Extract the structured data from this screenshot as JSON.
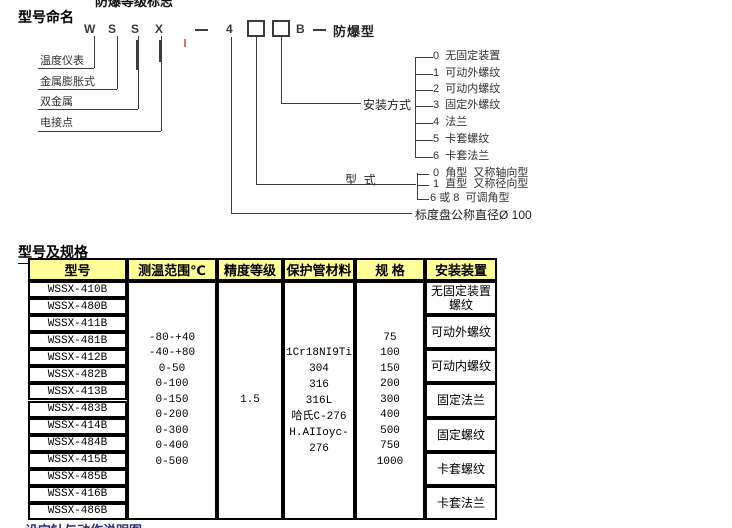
{
  "page": {
    "top_clipped_text": "防爆等级标志",
    "bottom_clipped_text": "设定针与动作说明图"
  },
  "colors": {
    "table_header_bg": "#FFFF99",
    "table_border": "#000000",
    "diagram_line": "#3d3d3d",
    "clipped_heading_text": "#2b2b7a"
  },
  "section1": {
    "title": "型号命名",
    "code": {
      "letters": [
        "W",
        "S",
        "S",
        "X"
      ],
      "dash1": "—",
      "digit": "4",
      "suffix_letter": "B",
      "dash2": "—",
      "suffix_label": "防爆型"
    },
    "left_labels": [
      "温度仪表",
      "金属膨胀式",
      "双金属",
      "电接点"
    ],
    "install_branch": {
      "label": "安装方式",
      "options": [
        {
          "num": "0",
          "text": "无固定装置"
        },
        {
          "num": "1",
          "text": "可动外螺纹"
        },
        {
          "num": "2",
          "text": "可动内螺纹"
        },
        {
          "num": "3",
          "text": "固定外螺纹"
        },
        {
          "num": "4",
          "text": "法兰"
        },
        {
          "num": "5",
          "text": "卡套螺纹"
        },
        {
          "num": "6",
          "text": "卡套法兰"
        }
      ]
    },
    "type_branch": {
      "label": "型  式",
      "options": [
        {
          "num": "0",
          "text": "角型",
          "alt": "又称轴向型"
        },
        {
          "num": "1",
          "text": "直型",
          "alt": "又称径向型"
        },
        {
          "num": "6 或 8",
          "text": "可调角型",
          "alt": ""
        }
      ]
    },
    "dial_note": "标度盘公称直径Ø 100"
  },
  "section2": {
    "title": "型号及规格",
    "headers": [
      "型号",
      "测温范围℃",
      "精度等级",
      "保护管材料",
      "规  格",
      "安装装置"
    ],
    "models": [
      "WSSX-410B",
      "WSSX-480B",
      "WSSX-411B",
      "WSSX-481B",
      "WSSX-412B",
      "WSSX-482B",
      "WSSX-413B",
      "WSSX-483B",
      "WSSX-414B",
      "WSSX-484B",
      "WSSX-415B",
      "WSSX-485B",
      "WSSX-416B",
      "WSSX-486B"
    ],
    "temp_ranges": [
      "-80-+40",
      "-40-+80",
      "0-50",
      "0-100",
      "0-150",
      "0-200",
      "0-300",
      "0-400",
      "0-500"
    ],
    "accuracy": "1.5",
    "materials": [
      "1Cr18NI9Ti",
      "304",
      "316",
      "316L",
      "哈氏C-276",
      "H.AIIoyc-276"
    ],
    "specs": [
      "75",
      "100",
      "150",
      "200",
      "300",
      "400",
      "500",
      "750",
      "1000"
    ],
    "install_devices": [
      "无固定装置螺纹",
      "可动外螺纹",
      "可动内螺纹",
      "固定法兰",
      "固定螺纹",
      "卡套螺纹",
      "卡套法兰"
    ]
  }
}
